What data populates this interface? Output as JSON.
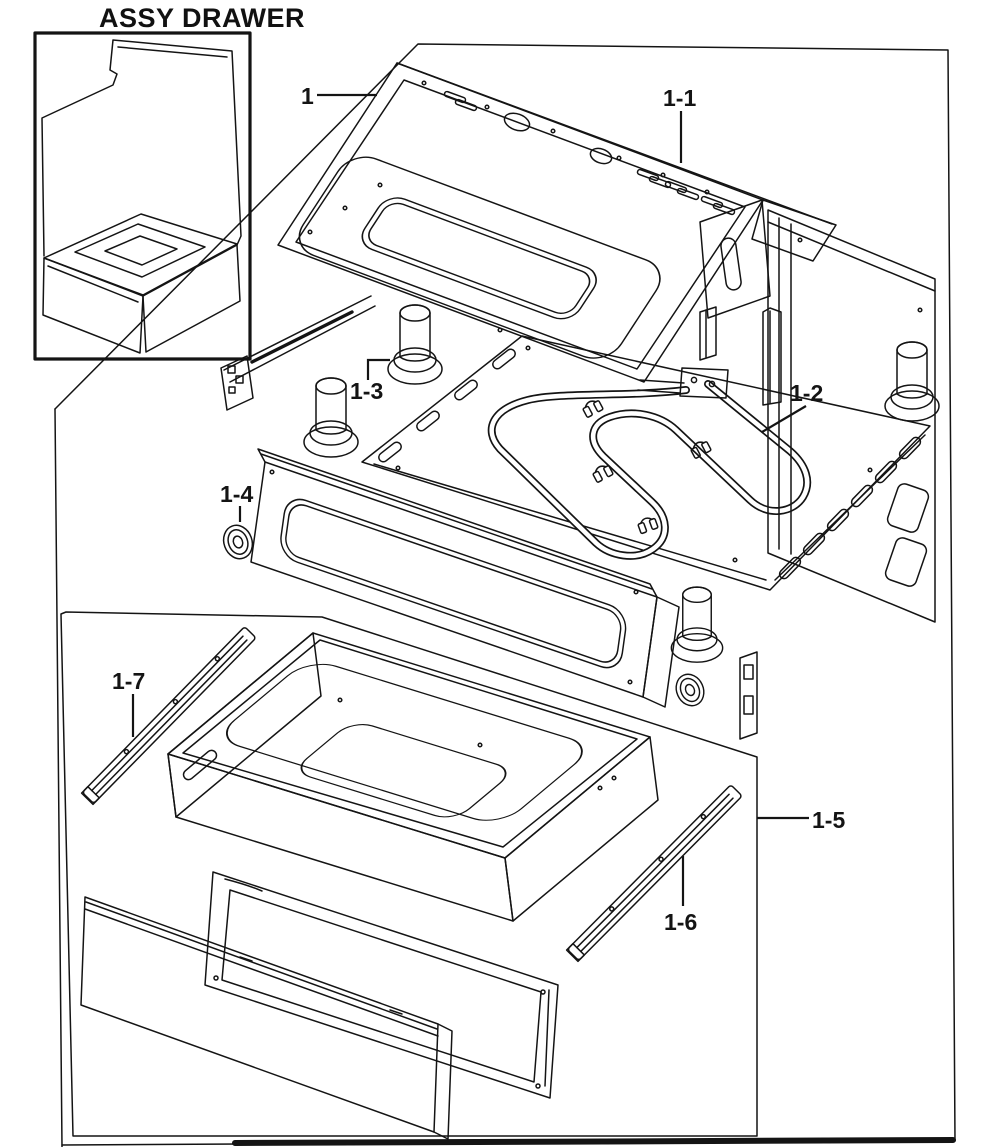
{
  "title": "ASSY DRAWER",
  "callouts": {
    "c1": "1",
    "c1_1": "1-1",
    "c1_2": "1-2",
    "c1_3": "1-3",
    "c1_4": "1-4",
    "c1_5": "1-5",
    "c1_6": "1-6",
    "c1_7": "1-7"
  },
  "colors": {
    "ink": "#141414",
    "paper": "#ffffff"
  }
}
